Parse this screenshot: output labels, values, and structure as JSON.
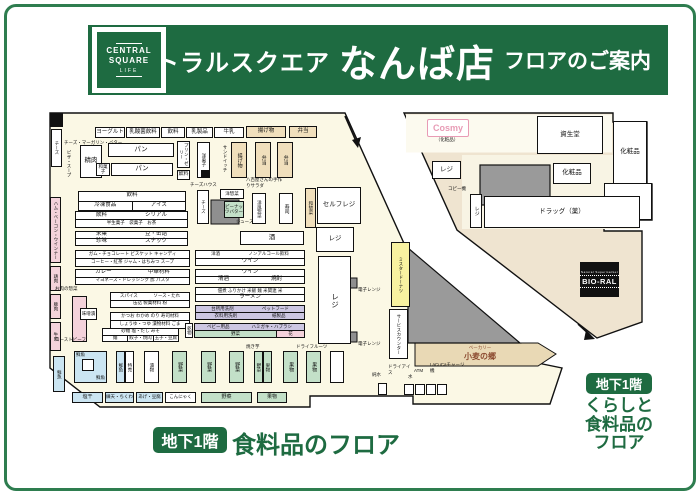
{
  "header": {
    "logo": {
      "line1": "CENTRAL",
      "line2": "SQUARE",
      "line3": "LIFE"
    },
    "title": {
      "prefix": "セントラルスクエア",
      "store": "なんば店",
      "suffix": "フロアのご案内"
    }
  },
  "floor_food": {
    "badge": "地下1階",
    "label": "食料品のフロア"
  },
  "floor_living": {
    "badge": "地下1階",
    "lines": [
      "くらしと",
      "食料品の",
      "フロア"
    ]
  },
  "labels": {
    "yogurt": "ヨーグルト",
    "nyusankin": "乳酸菌飲料",
    "drink": "飲料",
    "nyuseihin": "乳製品",
    "gyunyu": "牛乳",
    "ageten": "揚げ物",
    "bento": "弁当",
    "cheese": "チーズ",
    "cheesemarg": "チーズ・マーガリン・バター",
    "pizza": "ピザ・スープ",
    "ham": "ハム・ベーコン・ウインナー",
    "chicken": "鶏肉",
    "pork": "豚肉",
    "beef": "牛肉",
    "fish": "鮮魚",
    "seiniku": "精肉",
    "bread": "パン",
    "wagashi": "和菓子",
    "pudding": "プリン・ゼリー",
    "yogashi": "洋菓子",
    "sandwich": "サンドイッチ",
    "cheesehouse": "チーズハウス",
    "yoso": "洋惣菜",
    "peanut": "ピーナッツバター",
    "juicebar": "ジュースバー",
    "salad1": "八百屋さんの",
    "salad2": "手作りサラダ",
    "yofuzozai": "洋風惣菜",
    "sushi": "寿司",
    "wasozai": "和惣菜",
    "selfregi": "セルフレジ",
    "regi": "レジ",
    "sake": "酒",
    "wine": "ワイン",
    "microwave": "電子レンジ",
    "meatdeli": "お肉の惣菜",
    "misozuke": "味噌漬",
    "roastbeef": "ローストビーフ",
    "kanbutsu": "乾物",
    "veg": "野菜",
    "fruit": "果物",
    "tokubai": "特売",
    "tsukemono": "漬物",
    "yakiimo": "焼き芋",
    "dried": "ドライフルーツ",
    "shioboshi": "塩干",
    "neriten": "練天・ちくわ",
    "age": "あげ・豆腐",
    "konnyaku": "こんにゃく",
    "donut": "ミスタードーナツ",
    "service": "サービスカウンター",
    "bakery": "ベーカリー",
    "bakeryname": "小麦の郷",
    "dryice": "ドライアイス",
    "atm": "ATM",
    "junsui": "純水",
    "mizu": "水",
    "lacuca": "LaCuCaチャージ機",
    "cosmy": "Cosmy",
    "cosmysub": "（化粧品）",
    "shiseido": "資生堂",
    "cosme": "化粧品",
    "bungu": "文具",
    "copier": "コピー機",
    "drug": "ドラッグ（薬）",
    "bioral_top": "Natural Supermarket",
    "bioral": "BIO-RAL"
  },
  "tables": {
    "dtable": {
      "r1": "飲料",
      "r2a": "冷凍食品",
      "r2b": "アイス"
    },
    "t1": {
      "r1a": "飲料",
      "r1b": "シリアル",
      "r2": "半生菓子　袋菓子　お茶"
    },
    "t2": {
      "r1a": "米菓",
      "r1b": "豆・缶詰",
      "r2a": "珍味",
      "r2b": "スナック"
    },
    "t3": {
      "r1": "ガム・チョコレート ビスケット キャンディ",
      "r2": "コーヒー・紅茶 ジャム・はちみつ スープ"
    },
    "t4": {
      "r1a": "洋酒",
      "r1b": "ノンアルコール飲料",
      "r2": "ワイン"
    },
    "t5": {
      "r1a": "カレー",
      "r1b": "中華材料",
      "r2": "マヨネーズ・ドレッシング 酢 パスタ"
    },
    "t6": {
      "r1": "ワイン",
      "r2a": "清酒",
      "r2b": "焼酎"
    },
    "t7": {
      "r1": "佃煮 ふりかけ 米飯 麺 米関連 米",
      "r2": "ラーメン"
    },
    "t8": {
      "r1a": "スパイス",
      "r1b": "ソース・たれ",
      "r2": "缶詰 製菓材料 粉"
    },
    "t9": {
      "r1a": "台所用洗剤",
      "r1b": "ペットフード",
      "r2a": "衣料用洗剤",
      "r2b": "紙製品"
    },
    "t10": {
      "r1": "かつお わかめ のり 寿司材料",
      "r2": "しょうゆ・つゆ 漬物材料 ごま"
    },
    "t11": {
      "r1a": "ベビー用品",
      "r1b": "ハミガキ・ハブラシ",
      "r2a": "野菜",
      "r2b": "花"
    },
    "t12": {
      "r1": "砂糖 塩・だし みそ",
      "r2a": "麺",
      "r2b": "餃子・焼肉",
      "r2c": "玉子・豆腐"
    }
  },
  "colors": {
    "brand_green": "#1E6B41",
    "cream": "#FBF8E5",
    "beige": "#EFE4D0",
    "fish_blue": "#CBE5F2",
    "veg_green": "#C3E0C8",
    "meat_pink": "#F4D2DB",
    "daily_lavender": "#CDC7E2",
    "donut_yellow": "#F8F2A0",
    "cosmy_pink": "#E89BB5"
  }
}
